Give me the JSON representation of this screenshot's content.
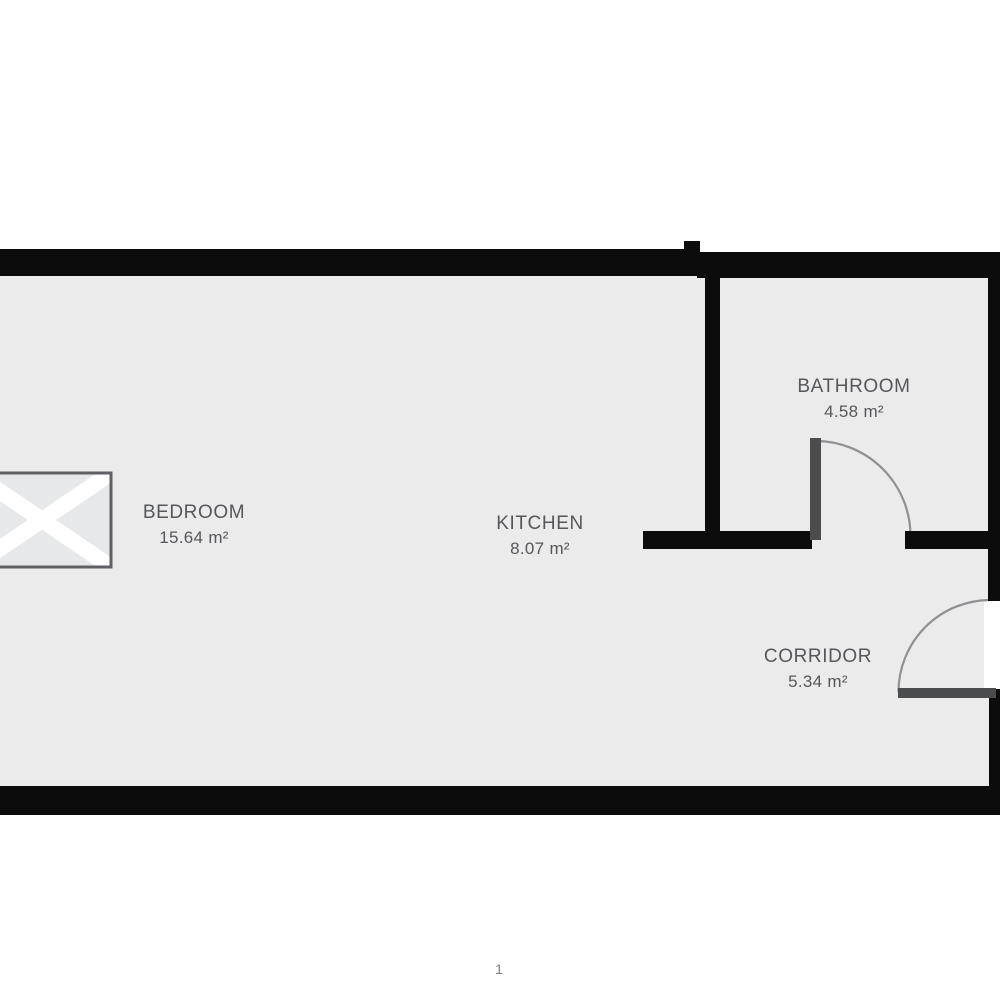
{
  "document": {
    "page_number": "1"
  },
  "floorplan": {
    "rooms": [
      {
        "id": "bedroom",
        "name": "BEDROOM",
        "area": "15.64 m²"
      },
      {
        "id": "kitchen",
        "name": "KITCHEN",
        "area": "8.07 m²"
      },
      {
        "id": "bathroom",
        "name": "BATHROOM",
        "area": "4.58 m²"
      },
      {
        "id": "corridor",
        "name": "CORRIDOR",
        "area": "5.34 m²"
      }
    ],
    "symbols": {
      "bedroom_furniture": "crossed-rectangle-bed-symbol",
      "doors": "quarter-circle-swing-arc"
    },
    "colors": {
      "wall": "#0c0c0c",
      "floor": "#ebebec",
      "background": "#ffffff",
      "door_leaf": "#4a4c4e",
      "door_arc": "#8f9093",
      "label_text": "#55575a",
      "furniture_fill": "#e7e8e9",
      "furniture_cross": "#ffffff",
      "furniture_border": "#5d5f63"
    }
  }
}
